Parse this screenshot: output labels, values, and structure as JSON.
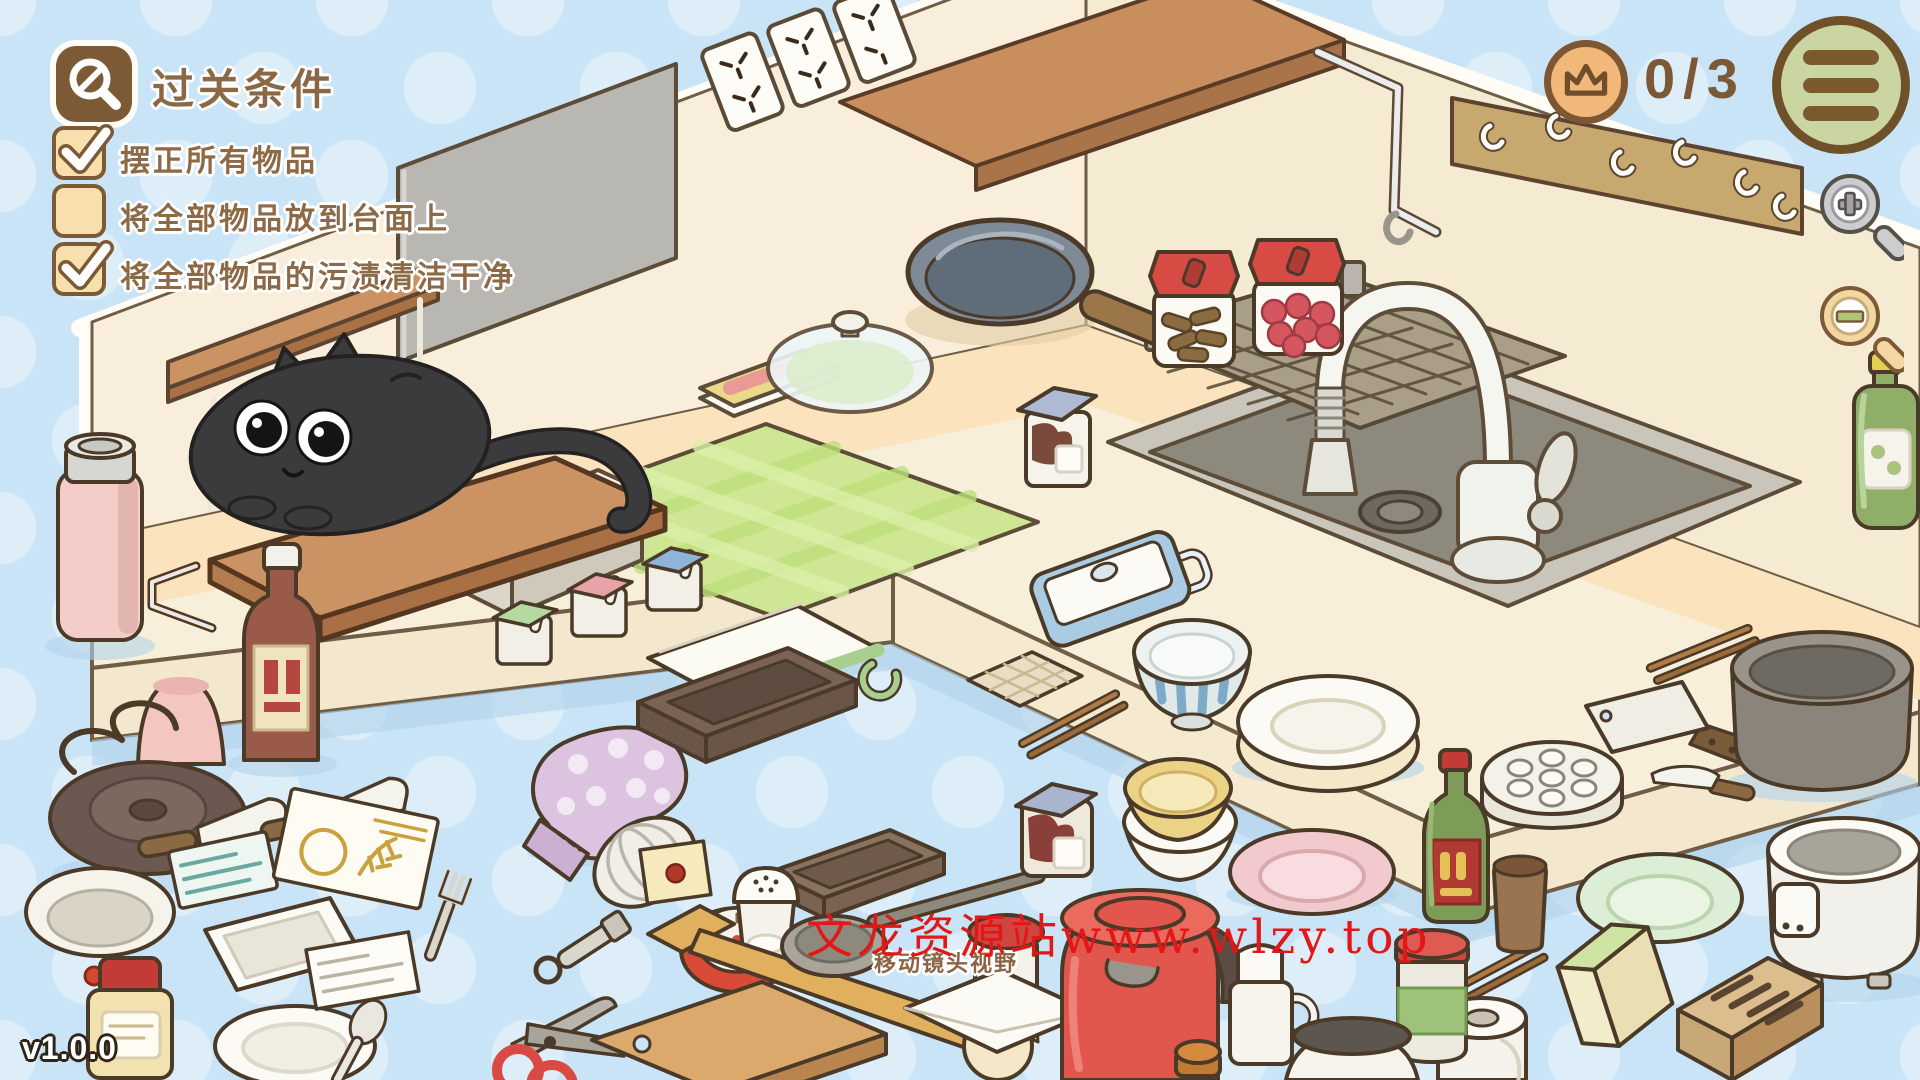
{
  "hud": {
    "goal_panel": {
      "icon": "magnifier-condition-icon",
      "title": "过关条件",
      "conditions": [
        {
          "label": "摆正所有物品",
          "checked": true
        },
        {
          "label": "将全部物品放到台面上",
          "checked": false
        },
        {
          "label": "将全部物品的污渍清洁干净",
          "checked": true
        }
      ]
    },
    "progress_badge": {
      "icon": "crown-icon",
      "text": "0/3"
    },
    "menu_button": {
      "icon": "hamburger-icon"
    },
    "zoom_controls": {
      "zoom_in_icon": "magnifier-plus-icon",
      "zoom_out_icon": "magnifier-minus-icon"
    },
    "version": "v1.0.0"
  },
  "scene": {
    "camera_hint": "移动镜头视野",
    "watermark": {
      "text": "文龙资源站www.wlzy.top",
      "color": "#e21717"
    },
    "palette": {
      "background_blue": "#c9e4f6",
      "wall_cream": "#f8eedb",
      "counter_peach": "#fae3bd",
      "counter_face": "#f3e7cd",
      "wood": "#c98e5e",
      "accent_brown": "#7d5a36",
      "badge_orange": "#f2b879",
      "menu_green": "#cbd5a2",
      "cat_gray": "#3b3b3d",
      "mat_green": "#cfe794",
      "jar_lid_red": "#d84a44",
      "kettle_red": "#e2574d"
    },
    "items": [
      "black-cat",
      "cutting-board",
      "green-checkered-mat",
      "recipe-book",
      "glass-lid",
      "frying-pan",
      "treat-jar",
      "berry-jar",
      "cocoa-jar",
      "shelf-stand",
      "seasoning-box-green",
      "seasoning-box-pink",
      "seasoning-box-blue",
      "sink",
      "dish-basket",
      "faucet",
      "wall-outlets",
      "wall-shelf",
      "hook-rack",
      "gray-wall-panel",
      "oil-bottle",
      "pink-thermos",
      "pink-cup",
      "sauce-bottle",
      "electric-hot-plate",
      "kitchen-knife",
      "paring-knife",
      "seed-packet-teal",
      "seed-packet-wheat",
      "white-bowl",
      "white-tray",
      "honey-jar",
      "white-plate-and-spoon",
      "postcard",
      "fork",
      "oven-mitt",
      "dish-towel",
      "waffle-cloth",
      "baking-pan",
      "brownie-pan",
      "whisk",
      "kitchen-timer",
      "sticky-note",
      "salt-shaker",
      "wooden-spatula",
      "ladle",
      "scissors",
      "wooden-board",
      "envelope-cat",
      "jam-jar-red",
      "red-kettle",
      "milk-jug",
      "sauce-jar-blue-lid",
      "blue-lunch-box",
      "striped-bowl",
      "stacked-plates",
      "stacked-bowls",
      "pink-plate",
      "chopsticks",
      "cleaver",
      "gray-pot",
      "steamer-plate",
      "vinegar-bottle",
      "brown-cup",
      "green-plate",
      "rice-cooker",
      "sponge",
      "knife-block",
      "paper-towel-roll",
      "pickle-jar",
      "orange-cap",
      "white-pot"
    ]
  }
}
